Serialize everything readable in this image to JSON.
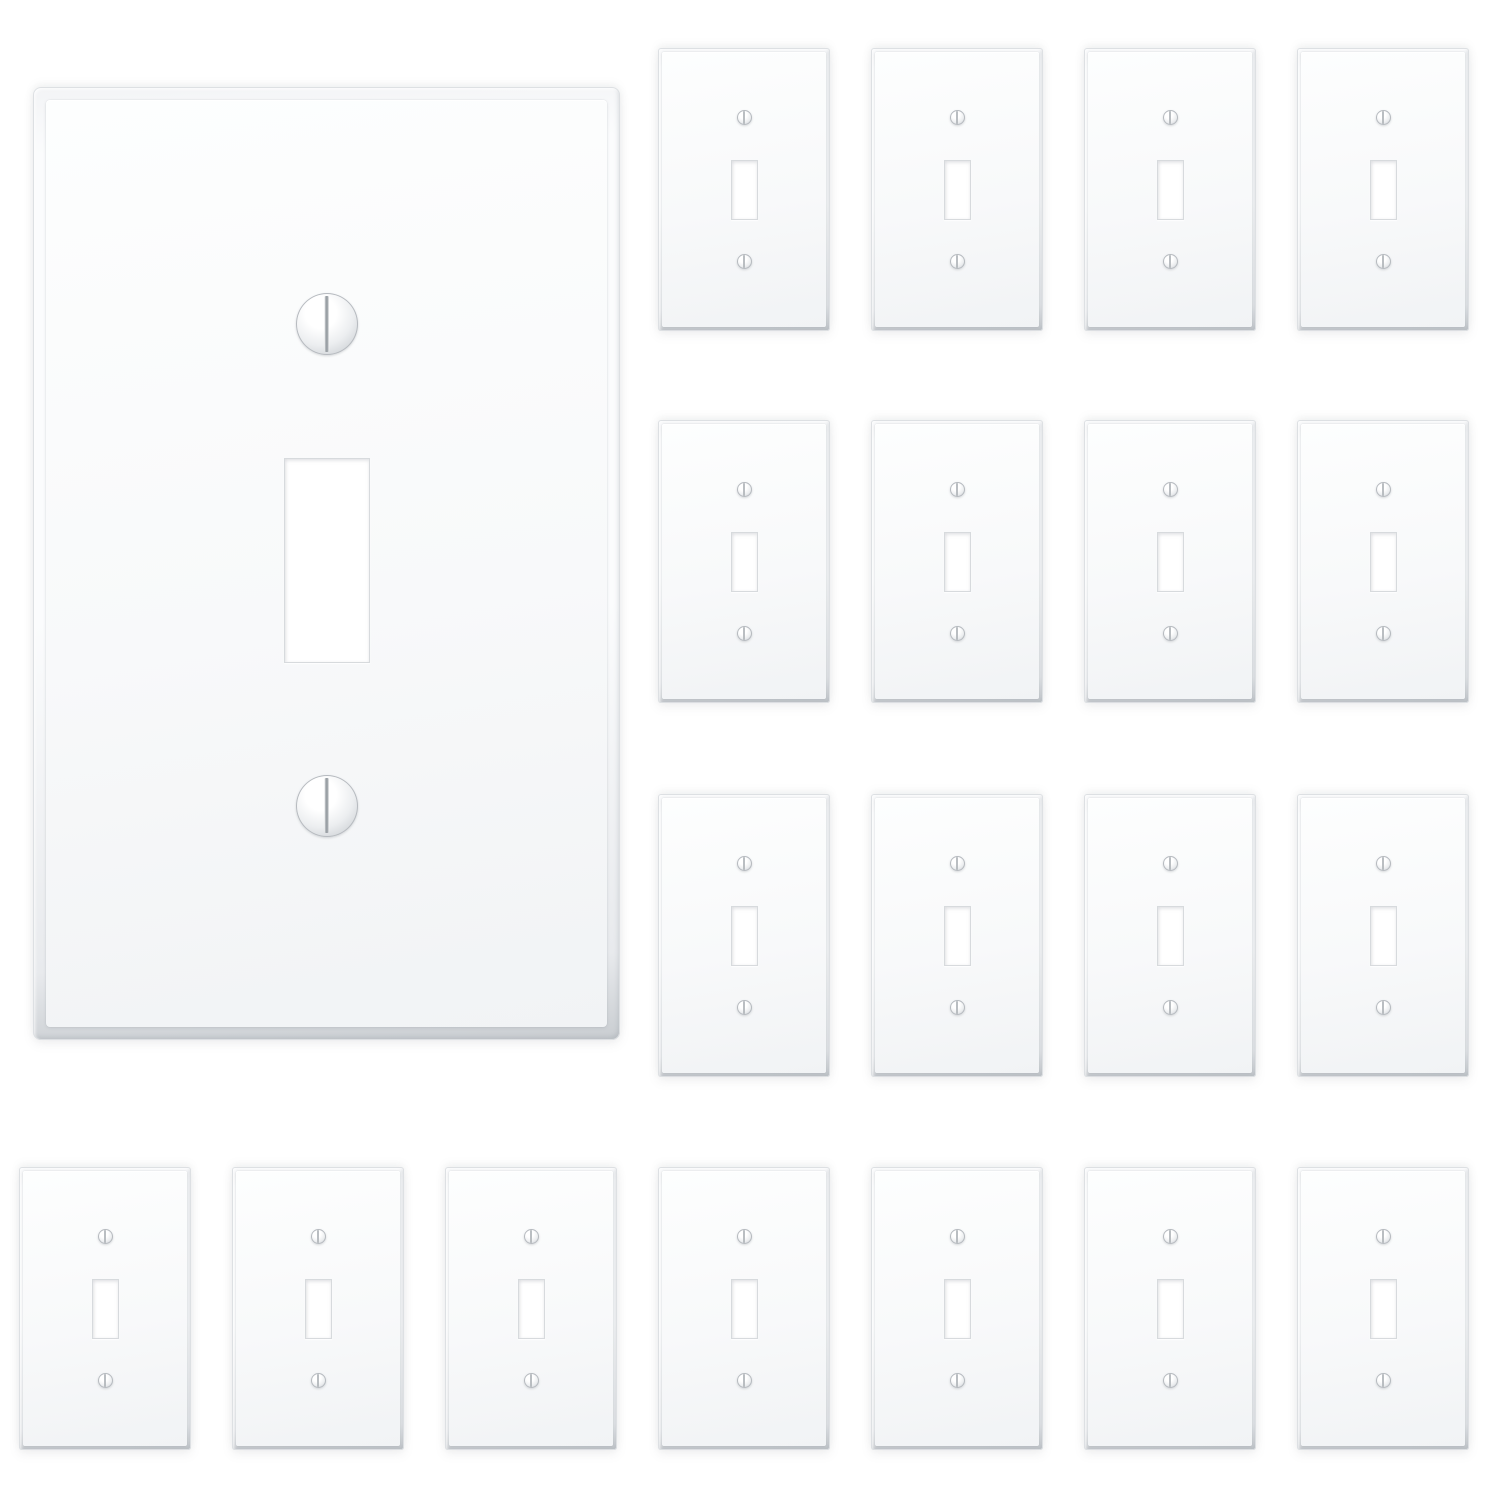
{
  "scene": {
    "type": "product-photo",
    "subject": "white single-gang toggle light switch wall plates",
    "canvas": {
      "width": 1500,
      "height": 1500
    },
    "plate_total_count": 21,
    "hero_plate_count": 1,
    "small_plate_count": 20
  },
  "colors": {
    "background": "#ffffff",
    "frame-grad-a": "#fbfcfd",
    "frame-grad-b": "#f3f4f6",
    "frame-grad-c": "#e8eaed",
    "frame-grad-d": "#c9cdd1",
    "frame-outline": "#dde0e3",
    "face-grad-a": "#fdfefe",
    "face-grad-b": "#f8f9fa",
    "face-grad-c": "#f1f3f5",
    "screw-hi": "#ffffff",
    "screw-mid": "#eceef0",
    "screw-lo": "#ccd0d4",
    "screw-ring": "#b6babf",
    "screw-slot": "#9aa0a5",
    "hole-fill": "#ffffff",
    "hole-border": "#d7dadd"
  },
  "plate_types": {
    "hero": {
      "width": 587,
      "height": 953,
      "bevel": 13,
      "corner_radius": 8,
      "face_radius": 4,
      "screw_diameter": 62,
      "screw_top_cy": 0.249,
      "screw_bottom_cy": 0.754,
      "hole_width": 86,
      "hole_height": 205,
      "hole_top": 0.389
    },
    "small": {
      "width": 172,
      "height": 283,
      "bevel": 4,
      "corner_radius": 3,
      "face_radius": 2,
      "screw_diameter": 15,
      "screw_top_cy": 0.245,
      "screw_bottom_cy": 0.755,
      "hole_width": 27,
      "hole_height": 60,
      "hole_top": 0.394
    }
  },
  "plates": [
    {
      "type": "hero",
      "x": 33,
      "y": 87
    },
    {
      "type": "small",
      "x": 658,
      "y": 48
    },
    {
      "type": "small",
      "x": 871,
      "y": 48
    },
    {
      "type": "small",
      "x": 1084,
      "y": 48
    },
    {
      "type": "small",
      "x": 1297,
      "y": 48
    },
    {
      "type": "small",
      "x": 658,
      "y": 420
    },
    {
      "type": "small",
      "x": 871,
      "y": 420
    },
    {
      "type": "small",
      "x": 1084,
      "y": 420
    },
    {
      "type": "small",
      "x": 1297,
      "y": 420
    },
    {
      "type": "small",
      "x": 658,
      "y": 794
    },
    {
      "type": "small",
      "x": 871,
      "y": 794
    },
    {
      "type": "small",
      "x": 1084,
      "y": 794
    },
    {
      "type": "small",
      "x": 1297,
      "y": 794
    },
    {
      "type": "small",
      "x": 19,
      "y": 1167
    },
    {
      "type": "small",
      "x": 232,
      "y": 1167
    },
    {
      "type": "small",
      "x": 445,
      "y": 1167
    },
    {
      "type": "small",
      "x": 658,
      "y": 1167
    },
    {
      "type": "small",
      "x": 871,
      "y": 1167
    },
    {
      "type": "small",
      "x": 1084,
      "y": 1167
    },
    {
      "type": "small",
      "x": 1297,
      "y": 1167
    }
  ]
}
